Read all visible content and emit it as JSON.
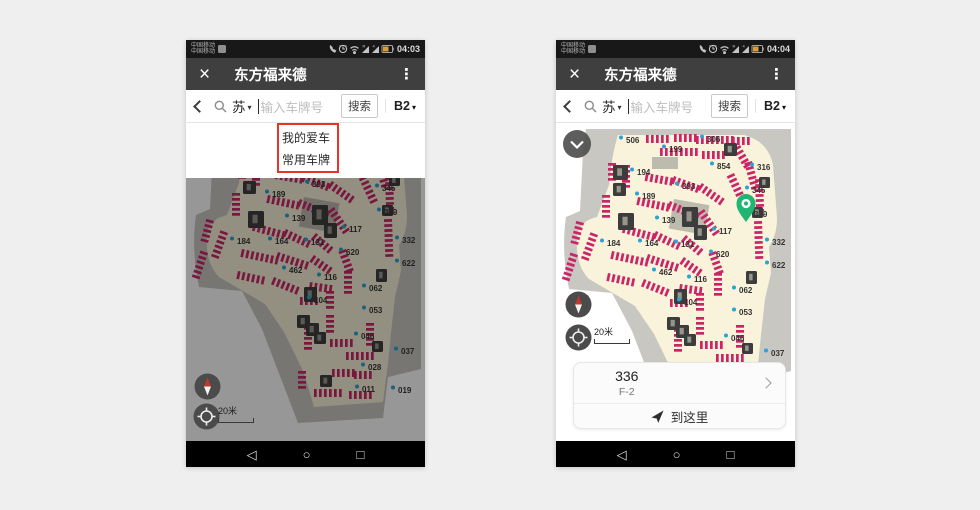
{
  "canvas": {
    "bg": "#efefef"
  },
  "navbar": {
    "back": "◁",
    "home": "○",
    "recents": "□"
  },
  "map": {
    "colors": {
      "cream": "#f8f3da",
      "gray": "#c8c7c2",
      "inner": "#bdbbae",
      "tick": "#cb2568",
      "dot": "#2ba3d4",
      "block": "#3c3c3c",
      "pin": "#1fb572"
    },
    "gray_path": "M30,6 L235,6 L235,248 L202,256 L197,297 L112,302 L76,208 L56,170 L13,166 Q5,128 10,94 L24,88 L27,28 Z",
    "cream_path": "M62,12 L188,12 Q212,18 217,42 L221,95 Q221,112 213,124 L215,150 L209,176 L205,212 L202,242 L197,281 L128,286 L118,252 L98,211 L79,183 L33,156 Q19,142 21,114 Q23,98 41,94 L53,62 Q56,30 62,12 Z",
    "inner": [
      [
        118,
        76,
        36,
        30,
        10
      ],
      [
        96,
        34,
        26,
        12,
        0
      ]
    ],
    "strips": [
      [
        90,
        12,
        0,
        5
      ],
      [
        118,
        11,
        0,
        5
      ],
      [
        140,
        13,
        0,
        8
      ],
      [
        176,
        14,
        0,
        4
      ],
      [
        104,
        25,
        0,
        8
      ],
      [
        146,
        28,
        0,
        5
      ],
      [
        184,
        22,
        60,
        5
      ],
      [
        196,
        38,
        75,
        6
      ],
      [
        60,
        40,
        90,
        4
      ],
      [
        74,
        42,
        90,
        5
      ],
      [
        90,
        50,
        10,
        6
      ],
      [
        118,
        53,
        20,
        6
      ],
      [
        146,
        60,
        35,
        6
      ],
      [
        178,
        50,
        65,
        7
      ],
      [
        207,
        56,
        88,
        8
      ],
      [
        54,
        72,
        90,
        5
      ],
      [
        82,
        74,
        12,
        7
      ],
      [
        114,
        78,
        22,
        7
      ],
      [
        148,
        86,
        55,
        6
      ],
      [
        206,
        98,
        88,
        8
      ],
      [
        28,
        100,
        105,
        5
      ],
      [
        42,
        112,
        110,
        6
      ],
      [
        68,
        102,
        15,
        7
      ],
      [
        100,
        108,
        25,
        6
      ],
      [
        130,
        112,
        40,
        5
      ],
      [
        22,
        132,
        108,
        6
      ],
      [
        56,
        128,
        12,
        8
      ],
      [
        92,
        131,
        18,
        7
      ],
      [
        128,
        134,
        35,
        5
      ],
      [
        160,
        128,
        70,
        5
      ],
      [
        52,
        150,
        12,
        6
      ],
      [
        88,
        156,
        22,
        6
      ],
      [
        124,
        161,
        8,
        5
      ],
      [
        166,
        150,
        90,
        5
      ],
      [
        114,
        176,
        0,
        4
      ],
      [
        148,
        170,
        90,
        4
      ],
      [
        148,
        194,
        90,
        4
      ],
      [
        126,
        206,
        90,
        5
      ],
      [
        144,
        218,
        0,
        5
      ],
      [
        160,
        231,
        0,
        6
      ],
      [
        188,
        202,
        90,
        5
      ],
      [
        146,
        248,
        0,
        5
      ],
      [
        120,
        250,
        90,
        4
      ],
      [
        168,
        250,
        0,
        4
      ],
      [
        128,
        268,
        0,
        6
      ],
      [
        163,
        270,
        0,
        5
      ]
    ],
    "blocks": [
      [
        57,
        42,
        15,
        15
      ],
      [
        57,
        60,
        13,
        13
      ],
      [
        168,
        20,
        13,
        13
      ],
      [
        126,
        84,
        16,
        20
      ],
      [
        138,
        102,
        13,
        15
      ],
      [
        62,
        90,
        16,
        17
      ],
      [
        118,
        166,
        13,
        15
      ],
      [
        111,
        194,
        13,
        13
      ],
      [
        120,
        202,
        13,
        13
      ],
      [
        128,
        211,
        12,
        12
      ],
      [
        203,
        54,
        11,
        11
      ],
      [
        190,
        148,
        11,
        13
      ],
      [
        186,
        220,
        11,
        11
      ],
      [
        134,
        254,
        12,
        12
      ],
      [
        196,
        84,
        11,
        11
      ]
    ],
    "labels": [
      [
        "506",
        70,
        17
      ],
      [
        "306",
        151,
        16
      ],
      [
        "199",
        113,
        26
      ],
      [
        "194",
        81,
        49
      ],
      [
        "854",
        161,
        43
      ],
      [
        "316",
        201,
        44
      ],
      [
        "393",
        126,
        63
      ],
      [
        "345",
        196,
        67
      ],
      [
        "189",
        86,
        73
      ],
      [
        "339",
        198,
        91
      ],
      [
        "139",
        106,
        97
      ],
      [
        "117",
        163,
        108
      ],
      [
        "184",
        51,
        120
      ],
      [
        "164",
        89,
        120
      ],
      [
        "131",
        125,
        121
      ],
      [
        "332",
        216,
        119
      ],
      [
        "620",
        160,
        131
      ],
      [
        "622",
        216,
        142
      ],
      [
        "462",
        103,
        149
      ],
      [
        "116",
        138,
        156
      ],
      [
        "062",
        183,
        167
      ],
      [
        "104",
        128,
        179
      ],
      [
        "053",
        183,
        189
      ],
      [
        "046",
        175,
        215
      ],
      [
        "037",
        215,
        230
      ],
      [
        "028",
        182,
        246
      ],
      [
        "011",
        176,
        268
      ],
      [
        "019",
        212,
        269
      ]
    ],
    "pin": {
      "x": 190,
      "y": 99
    }
  },
  "phones": {
    "left": {
      "status": {
        "carrier": "中国移动",
        "carrier2": "中国移动",
        "time": "04:03"
      },
      "title": {
        "close": "×",
        "text": "东方福来德",
        "menu": "⋮"
      },
      "search": {
        "province": "苏",
        "caret": "▾",
        "placeholder": "输入车牌号",
        "submit": "搜索",
        "floor": "B2",
        "floor_caret": "▾"
      },
      "menu": {
        "item1": "我的爱车",
        "item2": "常用车牌"
      },
      "scale": "20米"
    },
    "right": {
      "status": {
        "carrier": "中国移动",
        "carrier2": "中国移动",
        "time": "04:04"
      },
      "title": {
        "close": "×",
        "text": "东方福来德",
        "menu": "⋮"
      },
      "search": {
        "province": "苏",
        "caret": "▾",
        "placeholder": "输入车牌号",
        "submit": "搜索",
        "floor": "B2",
        "floor_caret": "▾"
      },
      "card": {
        "spot": "336",
        "floor": "F-2",
        "action": "到这里"
      },
      "scale": "20米"
    }
  }
}
